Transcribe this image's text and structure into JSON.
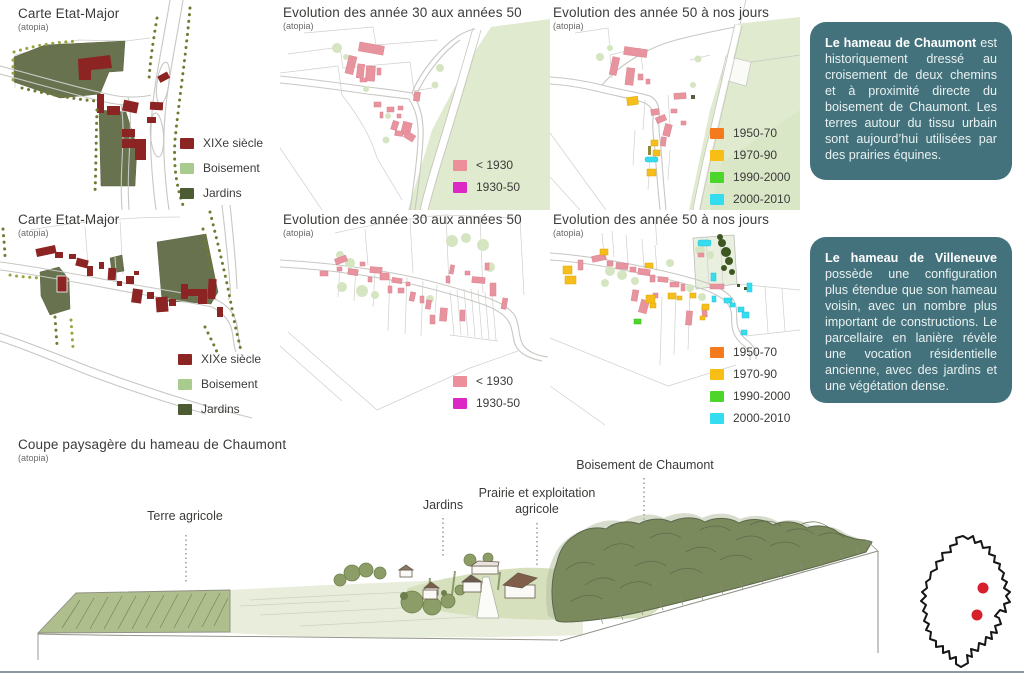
{
  "map_titles": {
    "etat_major": {
      "title": "Carte Etat-Major",
      "source": "(atopia)"
    },
    "evo_30_50": {
      "title": "Evolution des année 30 aux années 50",
      "source": "(atopia)"
    },
    "evo_50_jours": {
      "title": "Evolution des année 50 à nos jours",
      "source": "(atopia)"
    }
  },
  "legends": {
    "etat_major": {
      "items": [
        {
          "label": "XIXe siècle",
          "color": "#8C2423"
        },
        {
          "label": "Boisement",
          "color": "#A9CB8D"
        },
        {
          "label": "Jardins",
          "color": "#4C5B31"
        }
      ]
    },
    "evo_30_50": {
      "items": [
        {
          "label": "< 1930",
          "color": "#EC8F9B"
        },
        {
          "label": "1930-50",
          "color": "#DC28C4"
        }
      ]
    },
    "evo_50_jours": {
      "items": [
        {
          "label": "1950-70",
          "color": "#F5791D"
        },
        {
          "label": "1970-90",
          "color": "#F8BE16"
        },
        {
          "label": "1990-2000",
          "color": "#4CD62B"
        },
        {
          "label": "2000-2010",
          "color": "#33DCEF"
        }
      ]
    }
  },
  "notes": {
    "chaumont": {
      "lead": "Le hameau de Chaumont",
      "body": "est historiquement dressé au croisement de deux chemins et à proximité directe du boisement de Chaumont. Les terres autour du tissu urbain sont aujourd’hui utilisées par des prairies équines.",
      "background": "#44727C"
    },
    "villeneuve": {
      "lead": "Le hameau de Villeneuve",
      "body": "possède une configuration plus étendue que son hameau voisin, avec un nombre plus important de constructions. Le parcellaire en lanière révèle une vocation résidentielle ancienne, avec des jardins et une végétation dense.",
      "background": "#44727C"
    }
  },
  "section": {
    "title": "Coupe paysagère du hameau de Chaumont",
    "source": "(atopia)",
    "labels": {
      "terre_agricole": "Terre agricole",
      "jardins": "Jardins",
      "prairie": "Prairie et exploitation agricole",
      "boisement": "Boisement de Chaumont"
    }
  },
  "minimap": {
    "dot_color": "#D6202B"
  }
}
